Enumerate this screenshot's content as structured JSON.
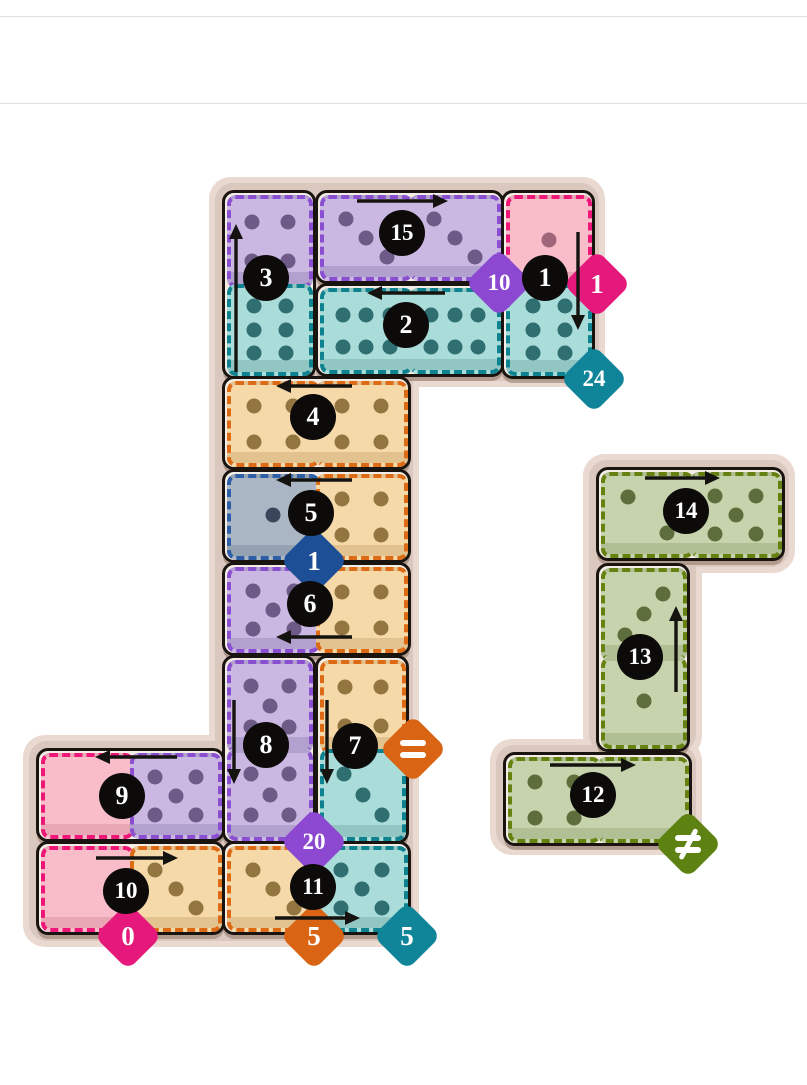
{
  "page": {
    "width": 807,
    "height": 1085,
    "rules_y": [
      16,
      103
    ]
  },
  "palette": {
    "board_bg": "#dac7be",
    "board_halo": "#ead9d1",
    "domino_border": "#1a1410",
    "domino_gap": "#f4ede6",
    "circle_bg": "#0c0b0a",
    "circle_text": "#ffffff",
    "arrow": "#151310",
    "cell_colors": {
      "purple": {
        "fill": "#cab7e2",
        "dark": "#b2a0ce",
        "pip": "#6e5a87",
        "dash": "#8a4fd0"
      },
      "teal": {
        "fill": "#aadcd9",
        "dark": "#92c6c3",
        "pip": "#2f6f72",
        "dash": "#0f8290"
      },
      "pink": {
        "fill": "#f9bdca",
        "dark": "#e9a6b5",
        "pip": "#9f657a",
        "dash": "#ee1677"
      },
      "orange": {
        "fill": "#f6d9a9",
        "dark": "#e2c38f",
        "pip": "#937540",
        "dash": "#dd6a14"
      },
      "gray": {
        "fill": "#aab6c3",
        "dark": "#94a2b1",
        "pip": "#3a475b",
        "dash": "#2e5ea6"
      },
      "green": {
        "fill": "#c7d3ac",
        "dark": "#b1bf95",
        "pip": "#5d6d3b",
        "dash": "#65810f"
      }
    },
    "badge_colors": {
      "purple": "#8c48d0",
      "magenta": "#e5197c",
      "teal": "#10859a",
      "navy": "#1c4f96",
      "orange": "#d96514",
      "green": "#5d8211"
    }
  },
  "boards": [
    {
      "name": "main-board",
      "panels": [
        [
          215,
          183,
          384,
          198
        ],
        [
          215,
          183,
          198,
          758
        ],
        [
          29,
          741,
          384,
          200
        ]
      ],
      "dominoes": [
        {
          "num": "3",
          "x": 222,
          "y": 190,
          "orient": "v",
          "cells": [
            {
              "color": "purple",
              "pips": 4
            },
            {
              "color": "teal",
              "pips": 6,
              "layout": "6v"
            }
          ],
          "circle": {
            "x": 266,
            "y": 278
          },
          "arrow": {
            "dir": "up",
            "x": 236,
            "y": 372,
            "len": 148
          }
        },
        {
          "num": "15",
          "x": 315,
          "y": 190,
          "orient": "h",
          "cells": [
            {
              "color": "purple",
              "pips": 3
            },
            {
              "color": "purple",
              "pips": 3
            }
          ],
          "circle": {
            "x": 402,
            "y": 233
          },
          "arrow": {
            "dir": "right",
            "x": 357,
            "y": 201,
            "len": 91
          }
        },
        {
          "num": "1",
          "x": 501,
          "y": 190,
          "orient": "v",
          "cells": [
            {
              "color": "pink",
              "pips": 1
            },
            {
              "color": "teal",
              "pips": 6,
              "layout": "6v"
            }
          ],
          "circle": {
            "x": 545,
            "y": 278
          },
          "arrow": {
            "dir": "down",
            "x": 578,
            "y": 232,
            "len": 98
          }
        },
        {
          "num": "2",
          "x": 315,
          "y": 283,
          "orient": "h",
          "cells": [
            {
              "color": "teal",
              "pips": 6,
              "layout": "6h"
            },
            {
              "color": "teal",
              "pips": 6,
              "layout": "6h"
            }
          ],
          "circle": {
            "x": 406,
            "y": 325
          },
          "arrow": {
            "dir": "left",
            "x": 445,
            "y": 293,
            "len": 78
          }
        },
        {
          "num": "4",
          "x": 222,
          "y": 376,
          "orient": "h",
          "cells": [
            {
              "color": "orange",
              "pips": 4
            },
            {
              "color": "orange",
              "pips": 4
            }
          ],
          "circle": {
            "x": 313,
            "y": 417
          },
          "arrow": {
            "dir": "left",
            "x": 352,
            "y": 386,
            "len": 76
          }
        },
        {
          "num": "5",
          "x": 222,
          "y": 469,
          "orient": "h",
          "cells": [
            {
              "color": "gray",
              "pips": 1
            },
            {
              "color": "orange",
              "pips": 4
            }
          ],
          "circle": {
            "x": 311,
            "y": 513
          },
          "arrow": {
            "dir": "left",
            "x": 352,
            "y": 480,
            "len": 76
          }
        },
        {
          "num": "6",
          "x": 222,
          "y": 562,
          "orient": "h",
          "cells": [
            {
              "color": "purple",
              "pips": 5
            },
            {
              "color": "orange",
              "pips": 4
            }
          ],
          "circle": {
            "x": 310,
            "y": 604
          },
          "arrow": {
            "dir": "left",
            "x": 352,
            "y": 637,
            "len": 76
          }
        },
        {
          "num": "8",
          "x": 222,
          "y": 655,
          "orient": "v",
          "cells": [
            {
              "color": "purple",
              "pips": 5
            },
            {
              "color": "purple",
              "pips": 5
            }
          ],
          "circle": {
            "x": 266,
            "y": 745
          },
          "arrow": {
            "dir": "down",
            "x": 234,
            "y": 700,
            "len": 84
          }
        },
        {
          "num": "7",
          "x": 315,
          "y": 655,
          "orient": "v",
          "cells": [
            {
              "color": "orange",
              "pips": 4
            },
            {
              "color": "teal",
              "pips": 3
            }
          ],
          "circle": {
            "x": 355,
            "y": 746
          },
          "arrow": {
            "dir": "down",
            "x": 327,
            "y": 700,
            "len": 84
          }
        },
        {
          "num": "9",
          "x": 36,
          "y": 748,
          "orient": "h",
          "cells": [
            {
              "color": "pink",
              "pips": 0
            },
            {
              "color": "purple",
              "pips": 5
            }
          ],
          "circle": {
            "x": 122,
            "y": 796
          },
          "arrow": {
            "dir": "left",
            "x": 177,
            "y": 757,
            "len": 82
          }
        },
        {
          "num": "10",
          "x": 36,
          "y": 841,
          "orient": "h",
          "cells": [
            {
              "color": "pink",
              "pips": 0
            },
            {
              "color": "orange",
              "pips": 3
            }
          ],
          "circle": {
            "x": 126,
            "y": 891
          },
          "arrow": {
            "dir": "right",
            "x": 96,
            "y": 858,
            "len": 82
          }
        },
        {
          "num": "11",
          "x": 222,
          "y": 841,
          "orient": "h",
          "cells": [
            {
              "color": "orange",
              "pips": 3
            },
            {
              "color": "teal",
              "pips": 5
            }
          ],
          "circle": {
            "x": 313,
            "y": 887
          },
          "arrow": {
            "dir": "right",
            "x": 275,
            "y": 918,
            "len": 85
          }
        }
      ],
      "badges": [
        {
          "label": "10",
          "color": "purple",
          "cx": 499,
          "cy": 283
        },
        {
          "label": "1",
          "color": "magenta",
          "cx": 597,
          "cy": 284
        },
        {
          "label": "24",
          "color": "teal",
          "cx": 594,
          "cy": 379
        },
        {
          "label": "1",
          "color": "navy",
          "cx": 314,
          "cy": 561
        },
        {
          "label": "=",
          "glyph": "eq",
          "color": "orange",
          "cx": 413,
          "cy": 749
        },
        {
          "label": "20",
          "color": "purple",
          "cx": 314,
          "cy": 842
        },
        {
          "label": "0",
          "color": "magenta",
          "cx": 128,
          "cy": 936
        },
        {
          "label": "5",
          "color": "orange",
          "cx": 314,
          "cy": 936
        },
        {
          "label": "5",
          "color": "teal",
          "cx": 407,
          "cy": 936
        }
      ]
    },
    {
      "name": "side-board",
      "panels": [
        [
          589,
          460,
          200,
          107
        ],
        [
          589,
          460,
          107,
          292
        ],
        [
          496,
          745,
          200,
          104
        ]
      ],
      "dominoes": [
        {
          "num": "14",
          "x": 596,
          "y": 467,
          "orient": "h",
          "cells": [
            {
              "color": "green",
              "pips": 2
            },
            {
              "color": "green",
              "pips": 5
            }
          ],
          "circle": {
            "x": 686,
            "y": 511
          },
          "arrow": {
            "dir": "right",
            "x": 645,
            "y": 478,
            "len": 75
          }
        },
        {
          "num": "13",
          "x": 596,
          "y": 563,
          "orient": "v",
          "cells": [
            {
              "color": "green",
              "pips": 3,
              "layout": "3a"
            },
            {
              "color": "green",
              "pips": 1
            }
          ],
          "circle": {
            "x": 640,
            "y": 657
          },
          "arrow": {
            "dir": "up",
            "x": 676,
            "y": 692,
            "len": 86
          }
        },
        {
          "num": "12",
          "x": 503,
          "y": 752,
          "orient": "h",
          "cells": [
            {
              "color": "green",
              "pips": 4
            },
            {
              "color": "green",
              "pips": 0
            }
          ],
          "circle": {
            "x": 593,
            "y": 795
          },
          "arrow": {
            "dir": "right",
            "x": 550,
            "y": 765,
            "len": 86
          }
        }
      ],
      "badges": [
        {
          "label": "≠",
          "glyph": "neq",
          "color": "green",
          "cx": 688,
          "cy": 844
        }
      ]
    }
  ]
}
